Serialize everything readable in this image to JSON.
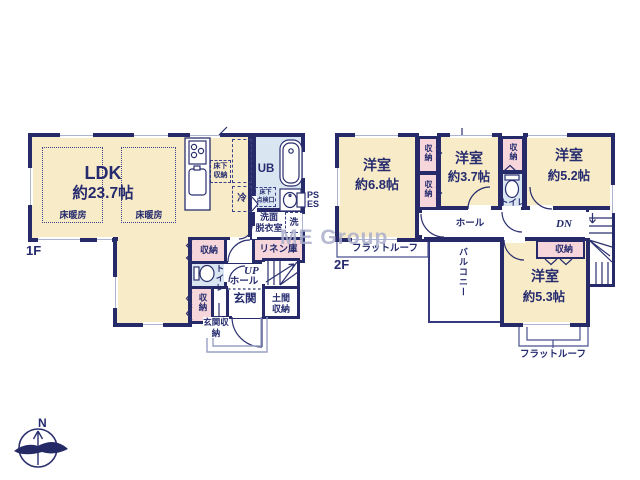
{
  "watermark": "ME Group",
  "compass": {
    "north": "N"
  },
  "colors": {
    "wall": "#262a68",
    "room_cream": "#f8ebc8",
    "closet_pink": "#f6d6da",
    "bath_blue": "#d9e6f2",
    "text_navy": "#252b6e",
    "watermark_gray": "#aaaeca"
  },
  "f1": {
    "floor_label": "1F",
    "ldk": {
      "name": "LDK",
      "size": "約23.7帖"
    },
    "floor_heating_left": "床暖房",
    "floor_heating_right": "床暖房",
    "underfloor_storage": "床下収納",
    "fridge": "冷",
    "unit_bath": "UB",
    "hatch_line1": "床下",
    "hatch_line2": "点検口",
    "ps": "PS",
    "es": "ES",
    "washroom_line1": "洗面",
    "washroom_line2": "脱衣室",
    "washer": "洗",
    "linen_closet": "リネン庫",
    "storage_center": "収納",
    "toilet": "トイレ",
    "up": "UP",
    "hall": "ホール",
    "entrance": "玄関",
    "doma_storage": "土間収納",
    "storage_side": "収納",
    "entrance_storage": "玄関収納"
  },
  "f2": {
    "floor_label": "2F",
    "room_a": {
      "name": "洋室",
      "size": "約6.8帖"
    },
    "room_b": {
      "name": "洋室",
      "size": "約3.7帖"
    },
    "room_c": {
      "name": "洋室",
      "size": "約5.2帖"
    },
    "room_d": {
      "name": "洋室",
      "size": "約5.3帖"
    },
    "closet_a": "収納",
    "closet_b": "収納",
    "closet_c": "収納",
    "closet_d": "収納",
    "toilet": "トイレ",
    "hall": "ホール",
    "dn": "DN",
    "balcony": "バルコニー",
    "flat_roof_top": "フラットルーフ",
    "flat_roof_bottom": "フラットルーフ"
  }
}
